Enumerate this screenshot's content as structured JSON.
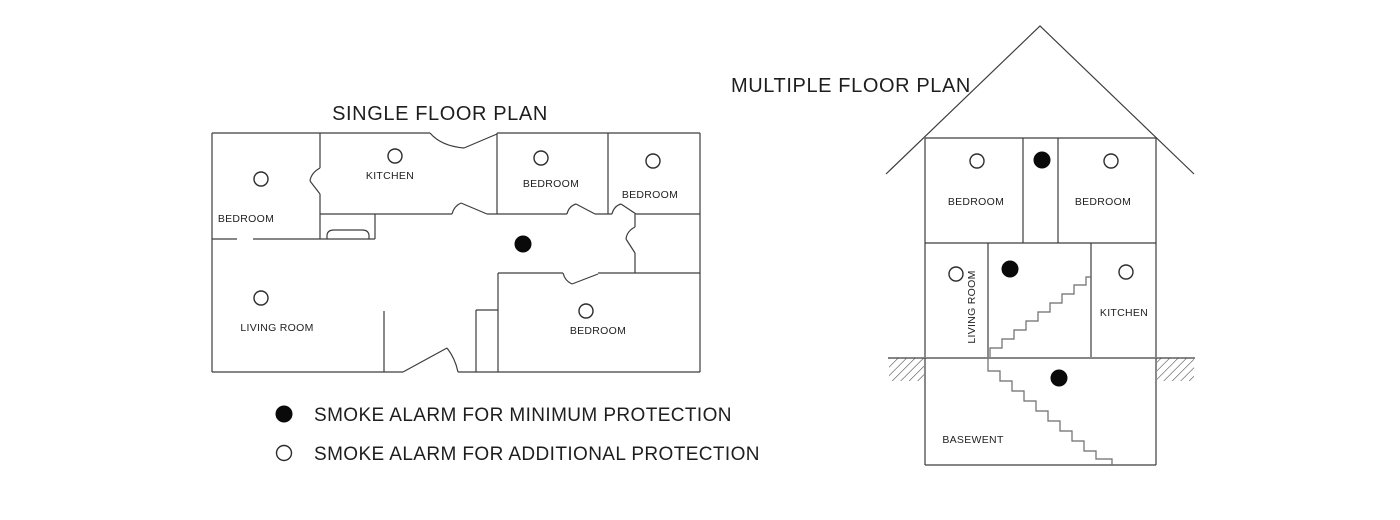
{
  "page": {
    "background": "#ffffff",
    "line_color": "#3d3d3d",
    "text_color": "#1e1e1e"
  },
  "single_plan": {
    "title": "SINGLE FLOOR PLAN",
    "rooms": [
      {
        "label": "BEDROOM",
        "alarm": "additional"
      },
      {
        "label": "KITCHEN",
        "alarm": "additional"
      },
      {
        "label": "BEDROOM",
        "alarm": "additional"
      },
      {
        "label": "BEDROOM",
        "alarm": "additional"
      },
      {
        "label": "LIVING ROOM",
        "alarm": "additional"
      },
      {
        "label": "BEDROOM",
        "alarm": "additional"
      }
    ],
    "hallway_alarm": "minimum"
  },
  "multiple_plan": {
    "title": "MULTIPLE FLOOR PLAN",
    "floors": [
      {
        "name": "upper floor",
        "rooms": [
          {
            "label": "BEDROOM",
            "alarm": "additional"
          },
          {
            "label": "BEDROOM",
            "alarm": "additional"
          }
        ],
        "hall_alarm": "minimum"
      },
      {
        "name": "main floor",
        "rooms": [
          {
            "label": "LIVING ROOM",
            "alarm": "additional"
          },
          {
            "label": "KITCHEN",
            "alarm": "additional"
          }
        ],
        "hall_alarm": "minimum"
      },
      {
        "name": "basement",
        "rooms": [
          {
            "label": "BASEWENT",
            "alarm": "minimum"
          }
        ]
      }
    ]
  },
  "legend": {
    "items": [
      {
        "icon": "filled-circle",
        "label": "SMOKE ALARM FOR MINIMUM PROTECTION"
      },
      {
        "icon": "open-circle",
        "label": "SMOKE ALARM FOR ADDITIONAL PROTECTION"
      }
    ]
  }
}
